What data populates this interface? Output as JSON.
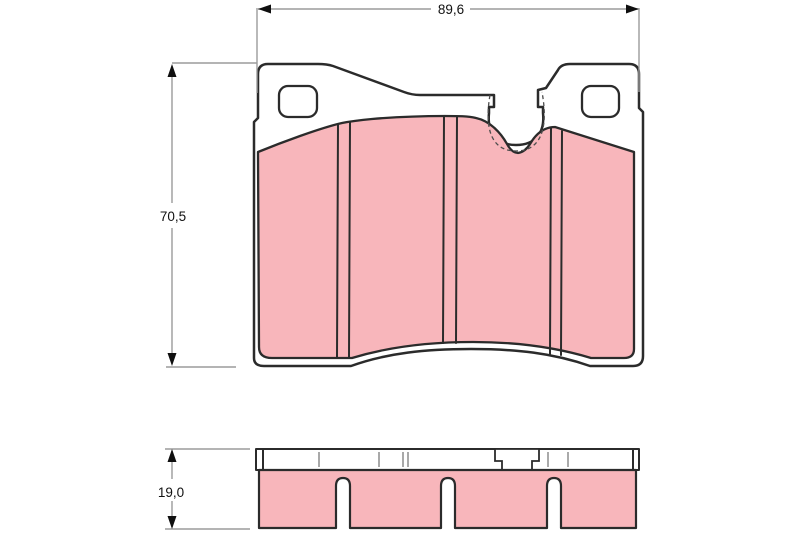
{
  "drawing": {
    "subject": "brake-pad-technical-drawing",
    "dimensions": {
      "width_label": "89,6",
      "height_label": "70,5",
      "thickness_label": "19,0"
    },
    "colors": {
      "background": "#ffffff",
      "outline": "#2b2b2b",
      "friction_fill": "#f8b6bb",
      "backplate_fill": "#ffffff",
      "dimension_line": "#9b9b9b",
      "dimension_text": "#111111"
    }
  }
}
